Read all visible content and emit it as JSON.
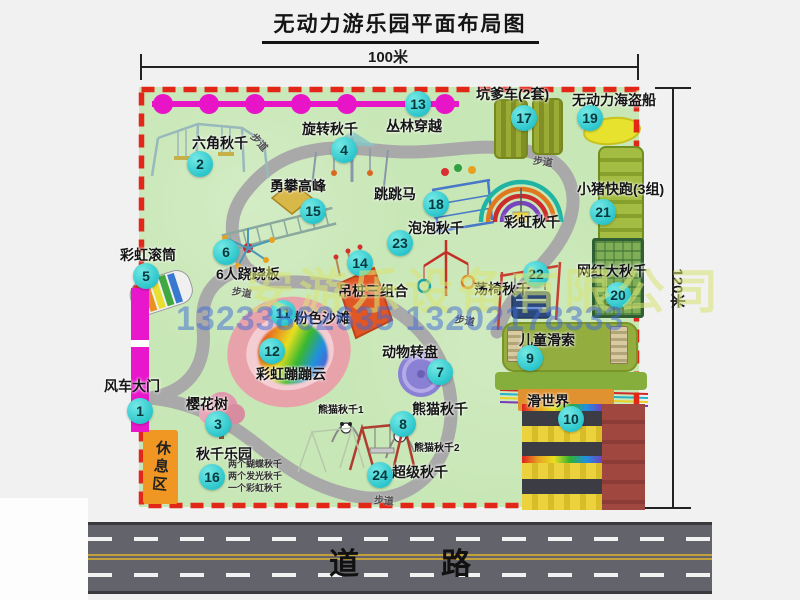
{
  "title": "无动力游乐园平面布局图",
  "dimensions": {
    "width_label": "100米",
    "height_label": "120米"
  },
  "road": {
    "label": "道　路"
  },
  "watermark": {
    "company": "安游乐设备有限公司",
    "phone": "13233862635 13202178333"
  },
  "labels": {
    "path": "步道",
    "rest_area": "休息区",
    "rainbow_swing": "彩虹秋千",
    "panda1": "熊猫秋千1",
    "panda2": "熊猫秋千2"
  },
  "swing_park_notes": [
    "两个蝴蝶秋千",
    "两个发光秋千",
    "一个彩虹秋千"
  ],
  "attractions": [
    {
      "num": "1",
      "label": "风车大门"
    },
    {
      "num": "2",
      "label": "六角秋千"
    },
    {
      "num": "3",
      "label": "樱花树"
    },
    {
      "num": "4",
      "label": "旋转秋千"
    },
    {
      "num": "5",
      "label": "彩虹滚筒"
    },
    {
      "num": "6",
      "label": "6人跷跷板"
    },
    {
      "num": "7",
      "label": "动物转盘"
    },
    {
      "num": "8",
      "label": "熊猫秋千"
    },
    {
      "num": "9",
      "label": "儿童滑索"
    },
    {
      "num": "10",
      "label": "滑世界"
    },
    {
      "num": "11",
      "label": "粉色沙滩"
    },
    {
      "num": "12",
      "label": "彩虹蹦蹦云"
    },
    {
      "num": "13",
      "label": "丛林穿越"
    },
    {
      "num": "14",
      "label": "吊桩三组合"
    },
    {
      "num": "15",
      "label": "勇攀高峰"
    },
    {
      "num": "16",
      "label": "秋千乐园"
    },
    {
      "num": "17",
      "label": "坑爹车(2套)"
    },
    {
      "num": "18",
      "label": "跳跳马"
    },
    {
      "num": "19",
      "label": "无动力海盗船"
    },
    {
      "num": "20",
      "label": "网红大秋千"
    },
    {
      "num": "21",
      "label": "小猪快跑(3组)"
    },
    {
      "num": "22",
      "label": "荡椅秋千"
    },
    {
      "num": "23",
      "label": "泡泡秋千"
    },
    {
      "num": "24",
      "label": "超级秋千"
    }
  ]
}
